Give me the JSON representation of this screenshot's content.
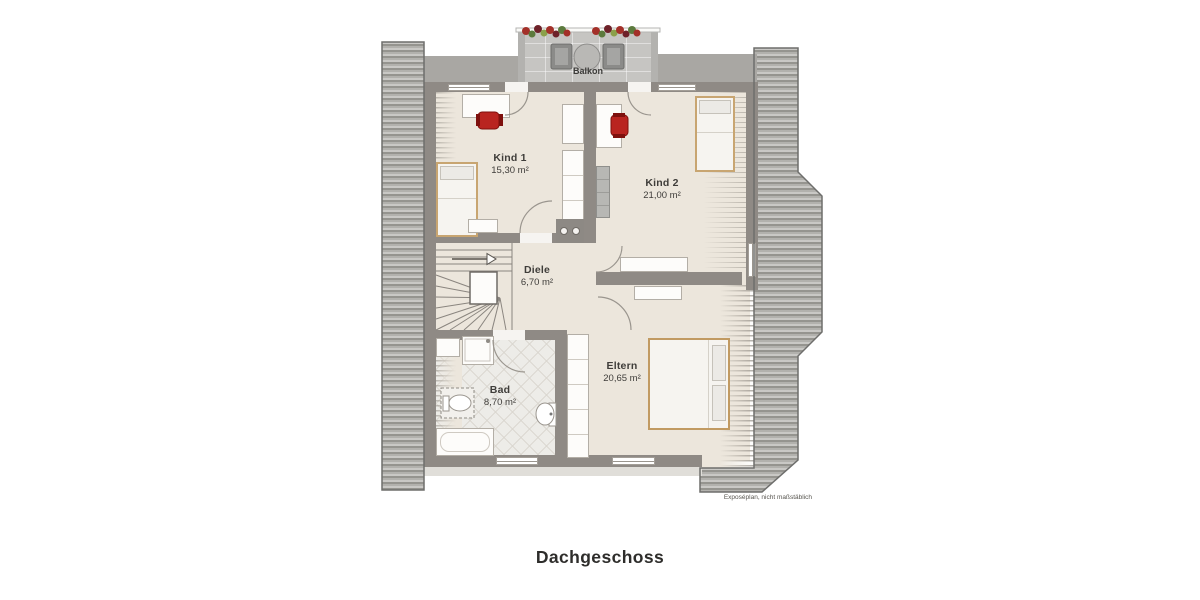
{
  "plan": {
    "title": "Dachgeschoss",
    "disclaimer": "Exposéplan, nicht maßstäblich",
    "balcony": {
      "label": "Balkon"
    },
    "rooms": [
      {
        "id": "kind1",
        "name": "Kind 1",
        "area": "15,30 m²"
      },
      {
        "id": "kind2",
        "name": "Kind 2",
        "area": "21,00 m²"
      },
      {
        "id": "diele",
        "name": "Diele",
        "area": "6,70 m²"
      },
      {
        "id": "eltern",
        "name": "Eltern",
        "area": "20,65 m²"
      },
      {
        "id": "bad",
        "name": "Bad",
        "area": "8,70 m²"
      }
    ],
    "colors": {
      "wall": "#8f8a85",
      "floor": "#ece6dc",
      "roof_dark": "#95948f",
      "roof_light": "#c9c8c5",
      "chair_accent": "#b92420",
      "wood_frame": "#c8a571"
    }
  }
}
